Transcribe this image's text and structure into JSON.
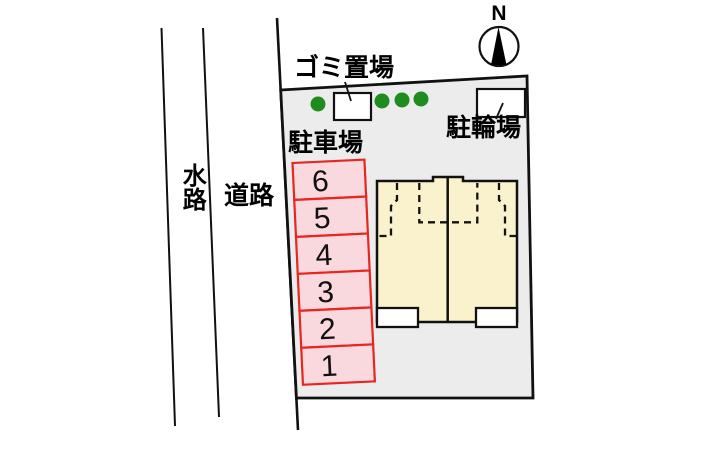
{
  "colors": {
    "site-fill": "#ececec",
    "building-fill": "#faf2cc",
    "parking-fill": "#f9d8de",
    "parking-border": "#e8251f",
    "tree-green": "#1f8c1f",
    "line": "#111111",
    "bg": "#ffffff"
  },
  "plan": {
    "compass": {
      "north_label": "N"
    },
    "left_annotations": {
      "waterway_label": "水路",
      "road_label": "道路"
    },
    "site": {
      "garbage_area": {
        "label": "ゴミ置場"
      },
      "bicycle_parking": {
        "label": "駐輪場"
      },
      "parking_lot": {
        "label": "駐車場",
        "stalls": [
          "6",
          "5",
          "4",
          "3",
          "2",
          "1"
        ]
      }
    }
  }
}
